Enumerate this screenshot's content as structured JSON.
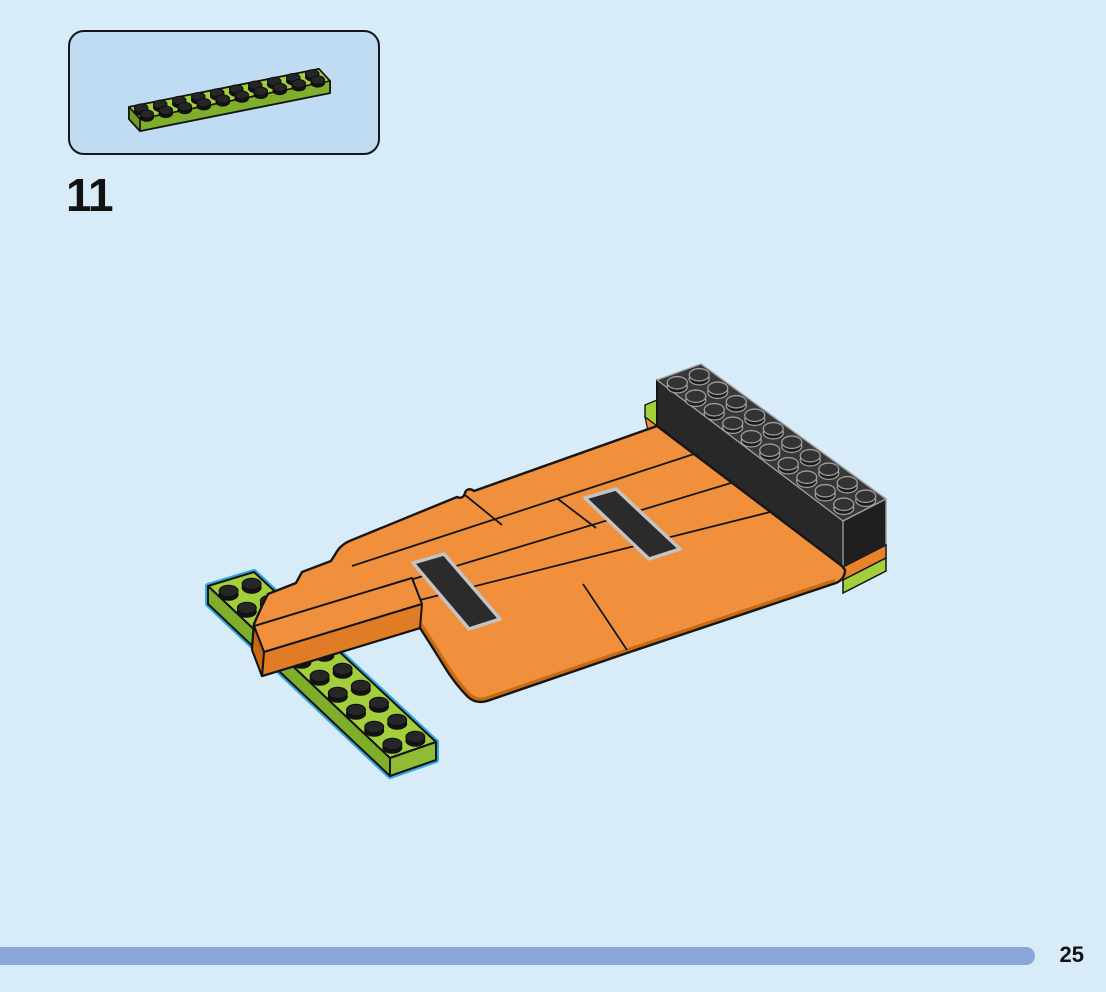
{
  "page": {
    "number": "25",
    "background_color_hex": "#D7EBF9"
  },
  "step": {
    "number": "11"
  },
  "parts_box": {
    "background_color_hex": "#BFDCF2",
    "border_color_hex": "#161616",
    "parts": [
      {
        "name": "plate-2x10",
        "color_name": "lime-green",
        "color_hex": "#A4CF3D",
        "studs_long": 10,
        "studs_wide": 2,
        "quantity_shown": 1
      }
    ]
  },
  "build_diagram": {
    "description": "Isometric assembly view: orange curved ramp with two black stripe tiles, a black 2x10 brick along the top-right edge resting on orange and lime plate layers, and a newly placed lime-green 2x10 plate at the bottom-left edge highlighted with a cyan outline",
    "highlight_color_hex": "#2FA9E1",
    "elements": [
      {
        "name": "black-brick-2x10",
        "color_hex": "#333333",
        "position": "top-right"
      },
      {
        "name": "orange-curved-ramp",
        "color_hex": "#F1903C",
        "position": "center"
      },
      {
        "name": "black-stripe-tile-left",
        "color_hex": "#2B2B2B",
        "position": "ramp-surface-left"
      },
      {
        "name": "black-stripe-tile-right",
        "color_hex": "#2B2B2B",
        "position": "ramp-surface-right"
      },
      {
        "name": "orange-plate-layer",
        "color_hex": "#E8822B",
        "position": "under-black-brick"
      },
      {
        "name": "lime-plate-layer",
        "color_hex": "#A4CF3D",
        "position": "under-black-brick"
      },
      {
        "name": "lime-plate-2x10-new-part",
        "color_hex": "#A4CF3D",
        "position": "bottom-left",
        "highlighted": true
      }
    ]
  },
  "progress_bar": {
    "color_hex": "#8BA6D8"
  }
}
